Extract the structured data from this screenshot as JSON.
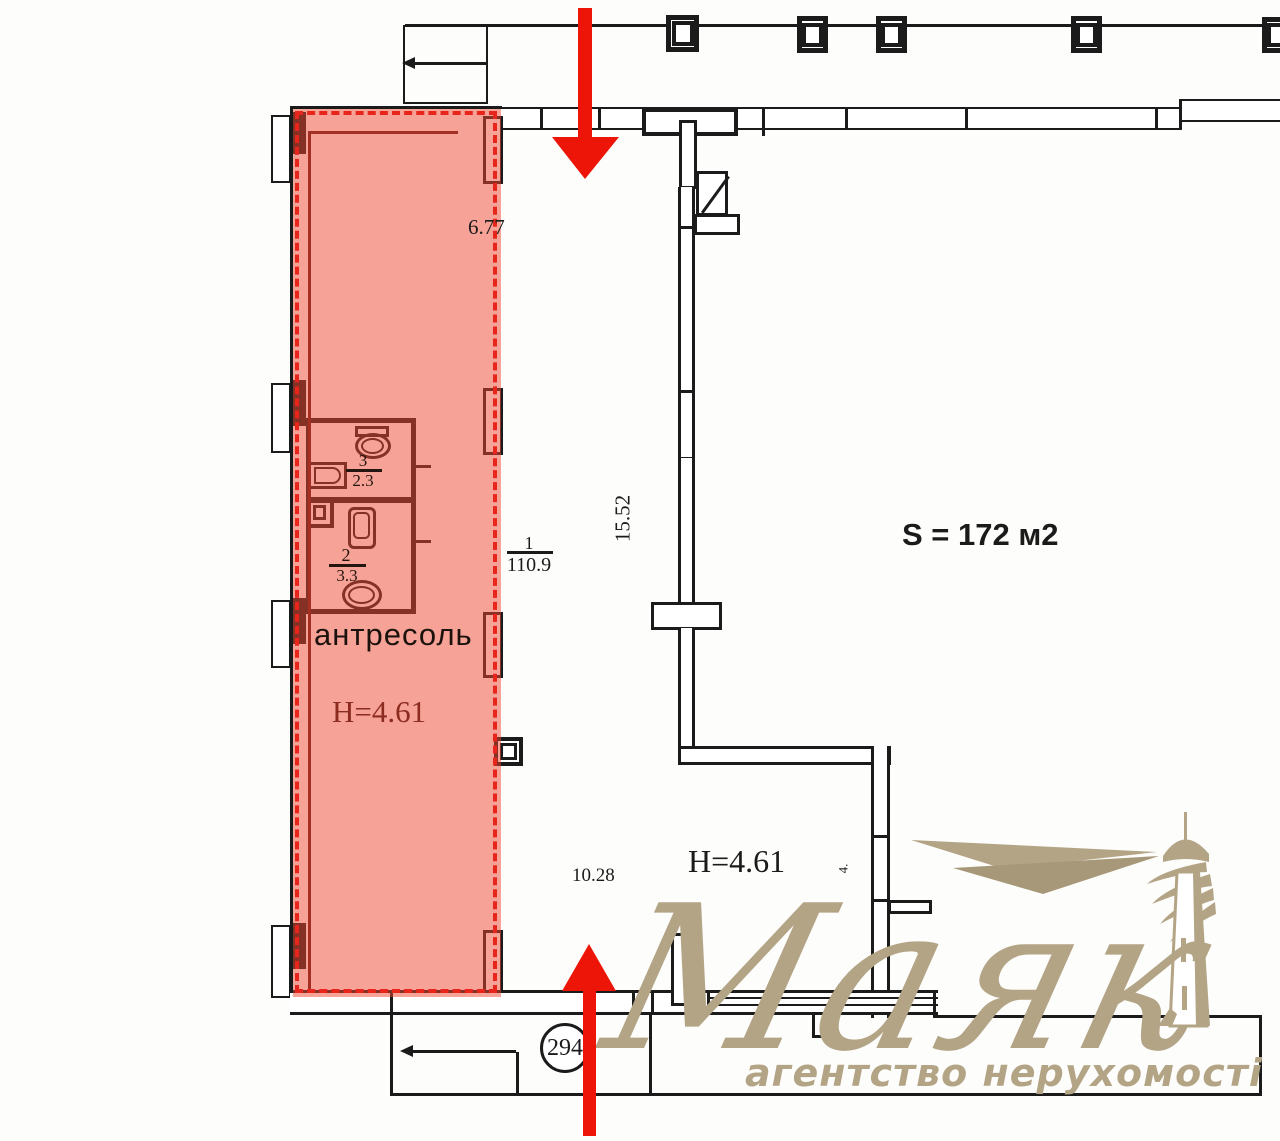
{
  "floorplan": {
    "area_label": "S = 172 м2",
    "unit_number": "294",
    "mezzanine": {
      "label": "антресоль",
      "height": "H=4.61"
    },
    "hall": {
      "height": "H=4.61",
      "room_no": "1",
      "area": "110.9",
      "length": "15.52"
    },
    "dimensions": {
      "top": "6.77",
      "bottom": "10.28",
      "side_small": "4."
    },
    "wc_upper": {
      "room_no": "3",
      "area": "2.3"
    },
    "wc_lower": {
      "room_no": "2",
      "area": "3.3"
    },
    "colors": {
      "highlight_fill": "#f04832",
      "highlight_dash": "#e8251a",
      "dark_red_text": "#8c2b20",
      "arrow_red": "#ec1508",
      "wall_ink": "#1b1b1b",
      "logo_tan": "#b3a486"
    }
  },
  "watermark": {
    "brand": "Маяк",
    "tagline": "агентство нерухомості"
  }
}
